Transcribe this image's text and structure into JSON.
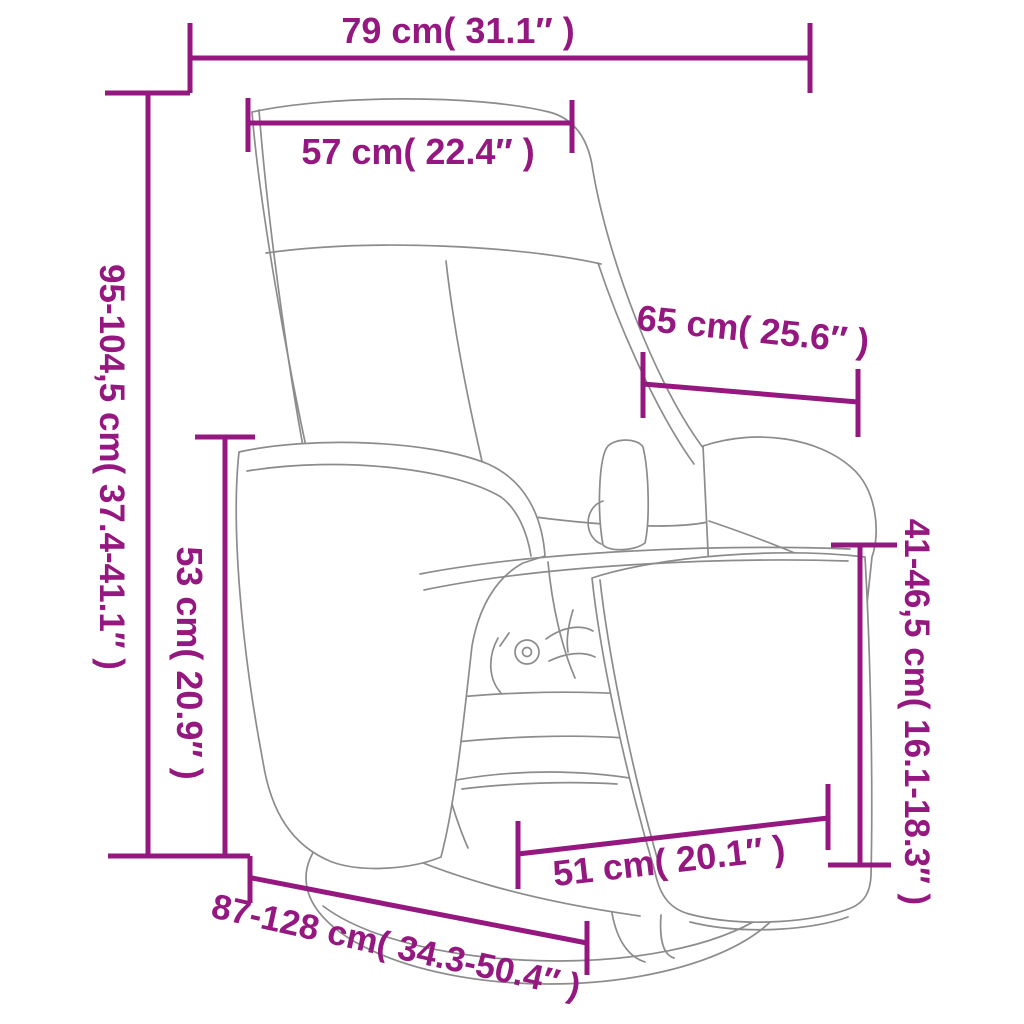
{
  "figure": {
    "title": "Recliner chair with footrest dimension diagram",
    "accent_color": "#94187F",
    "line_color": "#8C8C8C",
    "background_color": "#FFFFFF"
  },
  "dimensions": [
    {
      "id": "overall-width",
      "label": "79 cm( 31.1″ )"
    },
    {
      "id": "backrest-width",
      "label": "57 cm( 22.4″ )"
    },
    {
      "id": "overall-height",
      "label": "95-104,5 cm( 37.4-41.1″ )"
    },
    {
      "id": "backrest-depth",
      "label": "65 cm( 25.6″ )"
    },
    {
      "id": "armrest-height",
      "label": "53 cm( 20.9″ )"
    },
    {
      "id": "footrest-height",
      "label": "41-46,5 cm( 16.1-18.3″ )"
    },
    {
      "id": "seat-width",
      "label": "51 cm( 20.1″ )"
    },
    {
      "id": "overall-depth",
      "label": "87-128 cm( 34.3-50.4″ )"
    }
  ]
}
